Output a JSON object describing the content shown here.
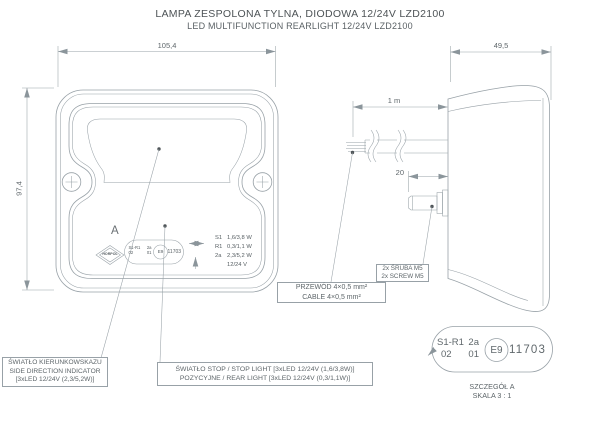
{
  "title": {
    "line1": "LAMPA ZESPOLONA TYLNA, DIODOWA 12/24V LZD2100",
    "line2": "LED MULTIFUNCTION REARLIGHT 12/24V LZD2100"
  },
  "colors": {
    "line": "#98a1a7",
    "text": "#60686c"
  },
  "front_view": {
    "dim_width": "105,4",
    "dim_height": "97,4",
    "detail_letter": "A",
    "brand": "HORPOL",
    "ratings": [
      {
        "code": "S1",
        "value": "1,6/3,8 W"
      },
      {
        "code": "R1",
        "value": "0,3/1,1 W"
      },
      {
        "code": "2a",
        "value": "2,3/5,2 W"
      },
      {
        "code": "",
        "value": "12/24 V"
      }
    ]
  },
  "side_view": {
    "dim_depth": "49,5",
    "dim_cable": "1 m",
    "dim_screw": "20"
  },
  "approval_mark": {
    "row1_left": "S1-R1",
    "row1_right": "2a",
    "row2_left": "02",
    "row2_right": "01",
    "e_mark": "E9",
    "number": "11703"
  },
  "labels": {
    "indicator": {
      "line1": "ŚWIATŁO KIERUNKOWSKAZU",
      "line2": "SIDE DIRECTION INDICATOR",
      "line3": "[3xLED 12/24V (2,3/5,2W)]"
    },
    "stop": {
      "line1": "ŚWIATŁO STOP / STOP LIGHT [3xLED 12/24V (1,6/3,8W)]",
      "line2": "POZYCYJNE  / REAR LIGHT [3xLED 12/24V (0,3/1,1W)]"
    },
    "cable": {
      "line1": "PRZEWÓD 4×0,5 mm²",
      "line2": "CABLE 4×0,5 mm²"
    },
    "screws": {
      "line1": "2x ŚRUBA M5",
      "line2": "2x SCREW M5"
    }
  },
  "detail": {
    "caption1": "SZCZEGÓŁ A",
    "caption2": "SKALA 3 : 1"
  }
}
